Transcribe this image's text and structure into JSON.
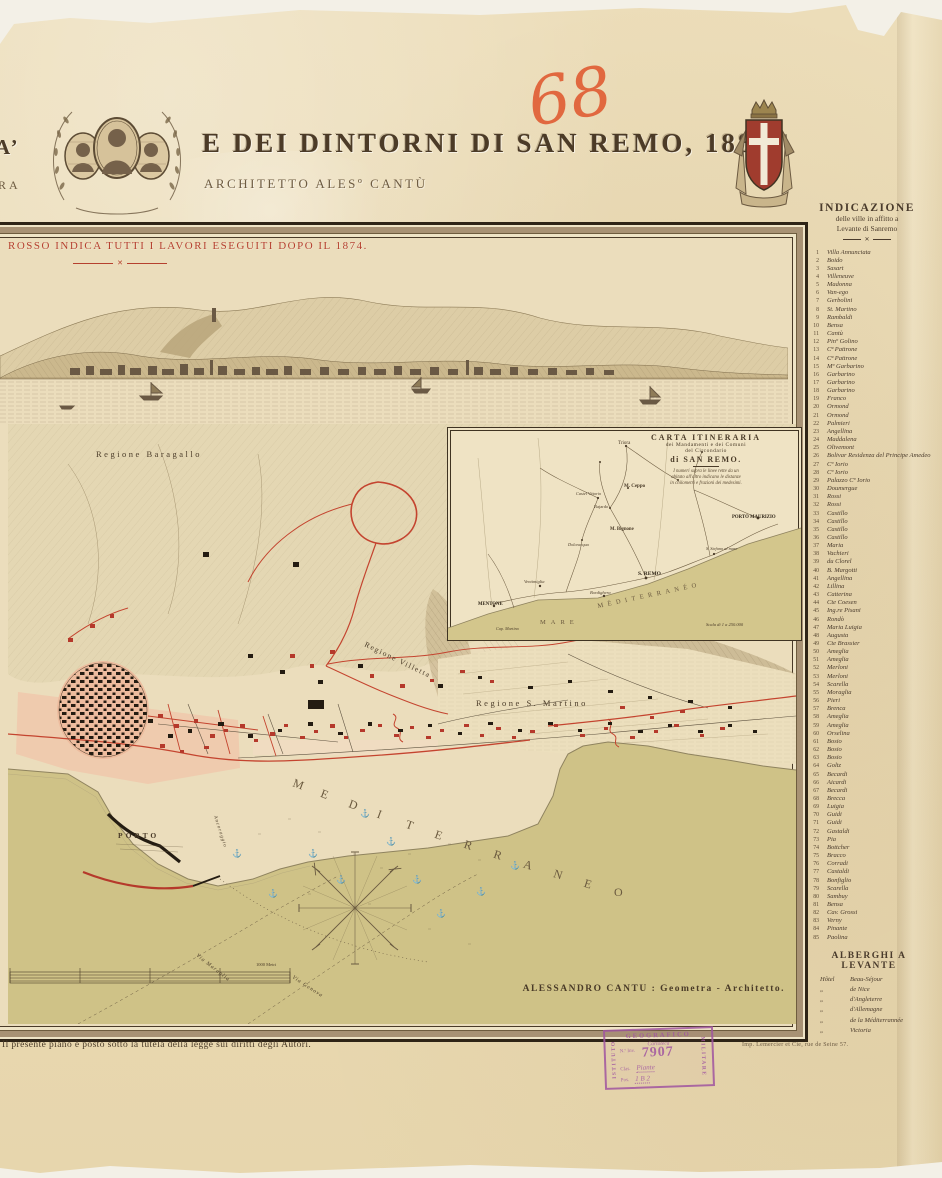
{
  "header": {
    "fragment_top": "A’",
    "fragment_bottom": "RA",
    "title": "E DEI DINTORNI DI SAN REMO, 1882",
    "subtitle": "ARCHITETTO ALESº CANTÙ",
    "handwritten_number": "68"
  },
  "legend": {
    "red_note": "ROSSO INDICA TUTTI I LAVORI ESEGUITI DOPO IL 1874.",
    "flourish": "✕"
  },
  "map": {
    "regione_baragallo": "Regione Baragallo",
    "regione_villetta": "Regione Villetta",
    "regione_s_martino": "Regione S. Martino",
    "porto": "PORTO",
    "ancoraggio": "Ancoraggio",
    "a_genova": "a Genova",
    "via_maraglia": "Via Maraglia",
    "via_genova": "Via Genova",
    "sea_label": "MEDITERRANEO",
    "scale_label": "1000 Metri",
    "signature": "ALESSANDRO CANTU : Geometra - Architetto."
  },
  "inset": {
    "title1": "CARTA ITINERARIA",
    "title2": "dei Mandamenti e dei Comuni",
    "title3": "del Circondario",
    "title4": "di SAN REMO.",
    "note1": "I numeri sopra le linee rette da un",
    "note2": "abitato all'altro indicano le distanze",
    "note3": "in chilometri e frazioni dei medesimi.",
    "labels": {
      "triora": "Triora",
      "m_ceppo": "M. Ceppo",
      "castel_vittorio": "Castel Vittorio",
      "bajardo": "Bajardo",
      "m_bignone": "M. Bignone",
      "dolceacqua": "Dolceacqua",
      "ventimiglia": "Ventimiglia",
      "bordighera": "Bordighera",
      "san_remo": "S. REMO",
      "s_stefano": "S. Stefano al mare",
      "porto_maurizio": "PORTO MAURIZIO",
      "mentone": "MENTONE",
      "capo_martino": "Cap. Martino",
      "mare": "MARE",
      "mediterraneo": "MÉDITERRANÉO",
      "scala": "Scala di 1 a 250.000"
    }
  },
  "sidebar": {
    "title": "INDICAZIONE",
    "subtitle1": "delle ville in affitto a",
    "subtitle2": "Levante di Sanremo",
    "villas": [
      "Villa Annunciata",
      "Boido",
      "Sasart",
      "Villeneuve",
      "Madonna",
      "Van-ego",
      "Gerbolini",
      "St. Martino",
      "Rambaldi",
      "Bensa",
      "Cantù",
      "Pinº Golino",
      "Cª Pattrone",
      "Cª Pattrone",
      "Mº Garbarino",
      "Garbarino",
      "Garbarino",
      "Garbarino",
      "Franco",
      "Ormond",
      "Ormond",
      "Palmieri",
      "Angellina",
      "Maddalena",
      "Olivemont",
      "Bolivar Residenza del Principe Amedeo",
      "Cº Iorio",
      "Cº Iorio",
      "Palazzo Cº Iorio",
      "Doumergue",
      "Rossi",
      "Rossi",
      "Castillo",
      "Castillo",
      "Castillo",
      "Castillo",
      "Maria",
      "Vachieri",
      "du Clorel",
      "B. Margotti",
      "Angellina",
      "Lillina",
      "Catterina",
      "Cte Coesen",
      "Ing.re Pisani",
      "Rondò",
      "Maria Luigia",
      "Augusta",
      "Cte Brassier",
      "Ameglia",
      "Ameglia",
      "Merloni",
      "Merloni",
      "Scarella",
      "Moraglia",
      "Pieri",
      "Brenca",
      "Ameglia",
      "Ameglia",
      "Orselina",
      "Bosio",
      "Bosio",
      "Bosio",
      "Goltz",
      "Becardi",
      "Aicardi",
      "Becardi",
      "Brecca",
      "Luigia",
      "Guidi",
      "Guidi",
      "Gastaldi",
      "Pia",
      "Bottcher",
      "Bracco",
      "Corradi",
      "Castaldi",
      "Bonfiglio",
      "Scarella",
      "Sambuy",
      "Bensa",
      "Cav. Grossi",
      "Verny",
      "Pinante",
      "Paolina"
    ],
    "hotels_header": "ALBERGHI A LEVANTE",
    "hotels": [
      {
        "p": "Hôtel",
        "n": "Beau-Séjour"
      },
      {
        "p": "„",
        "n": "de Nice"
      },
      {
        "p": "„",
        "n": "d'Angleterre"
      },
      {
        "p": "„",
        "n": "d'Allemagne"
      },
      {
        "p": "„",
        "n": "de la Méditerrannée"
      },
      {
        "p": "„",
        "n": "Victoria"
      }
    ]
  },
  "footer": {
    "copyright": "Il presente piano è posto sotto la tutela della legge sui diritti degli Autori.",
    "printer": "Imp. Lemercier et Cie, rue de Seine 57."
  },
  "stamp": {
    "left": "ISTITUTO",
    "top": "GEOGRAFICO",
    "right": "MILITARE",
    "row1": "Cartoteca",
    "inv_label": "N.º Inv.",
    "inv_value": "7907",
    "clas_label": "Clas.",
    "clas_value": "Piante",
    "pos_label": "Pos.",
    "pos_value": "1 B 2"
  },
  "colors": {
    "paper": "#ebddbc",
    "sea": "#cfc287",
    "red_works": "#c4442f",
    "pink_district": "#f0c8ac",
    "ink": "#4a3b28",
    "stamp_purple": "#a055a0",
    "handwriting_orange": "#e05b32"
  }
}
